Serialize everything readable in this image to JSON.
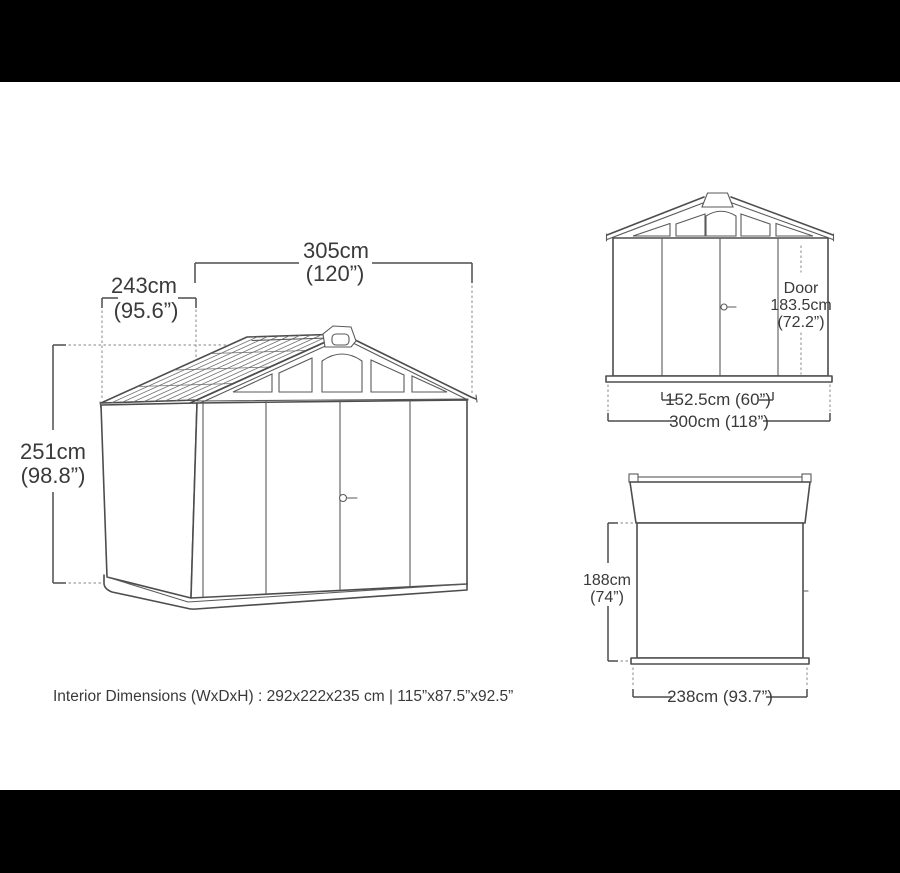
{
  "page": {
    "background": "#ffffff",
    "letterbox_color": "#000000",
    "line_color": "#4d4d4d",
    "text_color": "#3a3a3a",
    "dotted_color": "#9a9a9a"
  },
  "caption": {
    "text": "Interior Dimensions (WxDxH) : 292x222x235 cm | 115”x87.5”x92.5”"
  },
  "main_view": {
    "description": "shed perspective view",
    "width_cm": "305cm",
    "width_in": "(120”)",
    "depth_cm": "243cm",
    "depth_in": "(95.6”)",
    "height_cm": "251cm",
    "height_in": "(98.8”)"
  },
  "front_view": {
    "description": "shed front elevation",
    "door_label": "Door",
    "door_height_cm": "183.5cm",
    "door_height_in": "(72.2”)",
    "door_width": "152.5cm (60”)",
    "overall_width": "300cm (118”)"
  },
  "side_view": {
    "description": "shed side elevation",
    "wall_height_cm": "188cm",
    "wall_height_in": "(74”)",
    "overall_depth": "238cm (93.7”)"
  }
}
